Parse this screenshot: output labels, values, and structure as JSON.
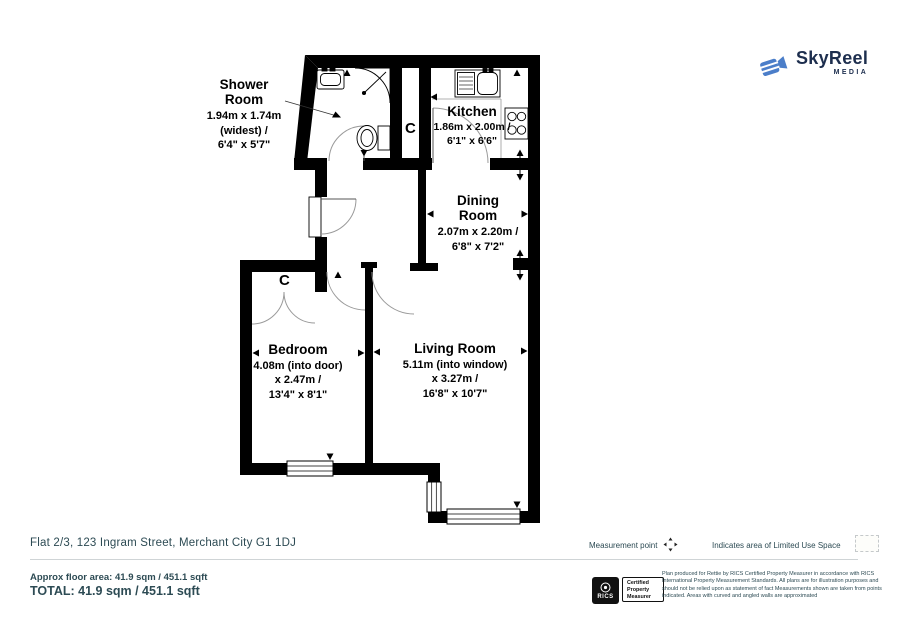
{
  "logo": {
    "name": "SkyReel",
    "sub": "MEDIA",
    "icon": "video-camera-icon",
    "colors": {
      "icon_blue": "#4b7ec9",
      "text_navy": "#1d2e4e"
    }
  },
  "floorplan": {
    "wall_color": "#000000",
    "cupboard_label": "C",
    "rooms": [
      {
        "id": "shower-room",
        "name": "Shower Room",
        "dims": [
          "1.94m x 1.74m",
          "(widest) /",
          "6'4\" x 5'7\""
        ]
      },
      {
        "id": "kitchen",
        "name": "Kitchen",
        "dims": [
          "1.86m x 2.00m /",
          "6'1\" x 6'6\""
        ]
      },
      {
        "id": "dining-room",
        "name": "Dining Room",
        "dims": [
          "2.07m x 2.20m /",
          "6'8\" x 7'2\""
        ]
      },
      {
        "id": "bedroom",
        "name": "Bedroom",
        "dims": [
          "4.08m (into door)",
          "x 2.47m /",
          "13'4\" x 8'1\""
        ]
      },
      {
        "id": "living-room",
        "name": "Living Room",
        "dims": [
          "5.11m (into window)",
          "x 3.27m /",
          "16'8\" x 10'7\""
        ]
      }
    ]
  },
  "footer": {
    "address": "Flat 2/3, 123 Ingram Street, Merchant City G1 1DJ",
    "measurement_point_label": "Measurement point",
    "measurement_point_icon": "four-way-arrow-icon",
    "limited_use_label": "Indicates area of  Limited Use Space",
    "limited_use_swatch": "dashed-area-swatch",
    "approx_area": "Approx floor area: 41.9 sqm / 451.1 sqft",
    "total": "TOTAL: 41.9 sqm / 451.1 sqft",
    "rics_label": "RICS",
    "rics_box_line1": "Certified",
    "rics_box_line2": "Property",
    "rics_box_line3": "Measurer",
    "disclaimer": "Plan produced for Rettie by RICS Certified Property Measurer in accordance with RICS International Property  Measurement Standards.  All plans are for illustration purposes and should not be relied upon as statement of fact Measurements shown are taken from points indicated.  Areas with curved and angled walls are approximated",
    "text_color": "#2d4b54"
  }
}
